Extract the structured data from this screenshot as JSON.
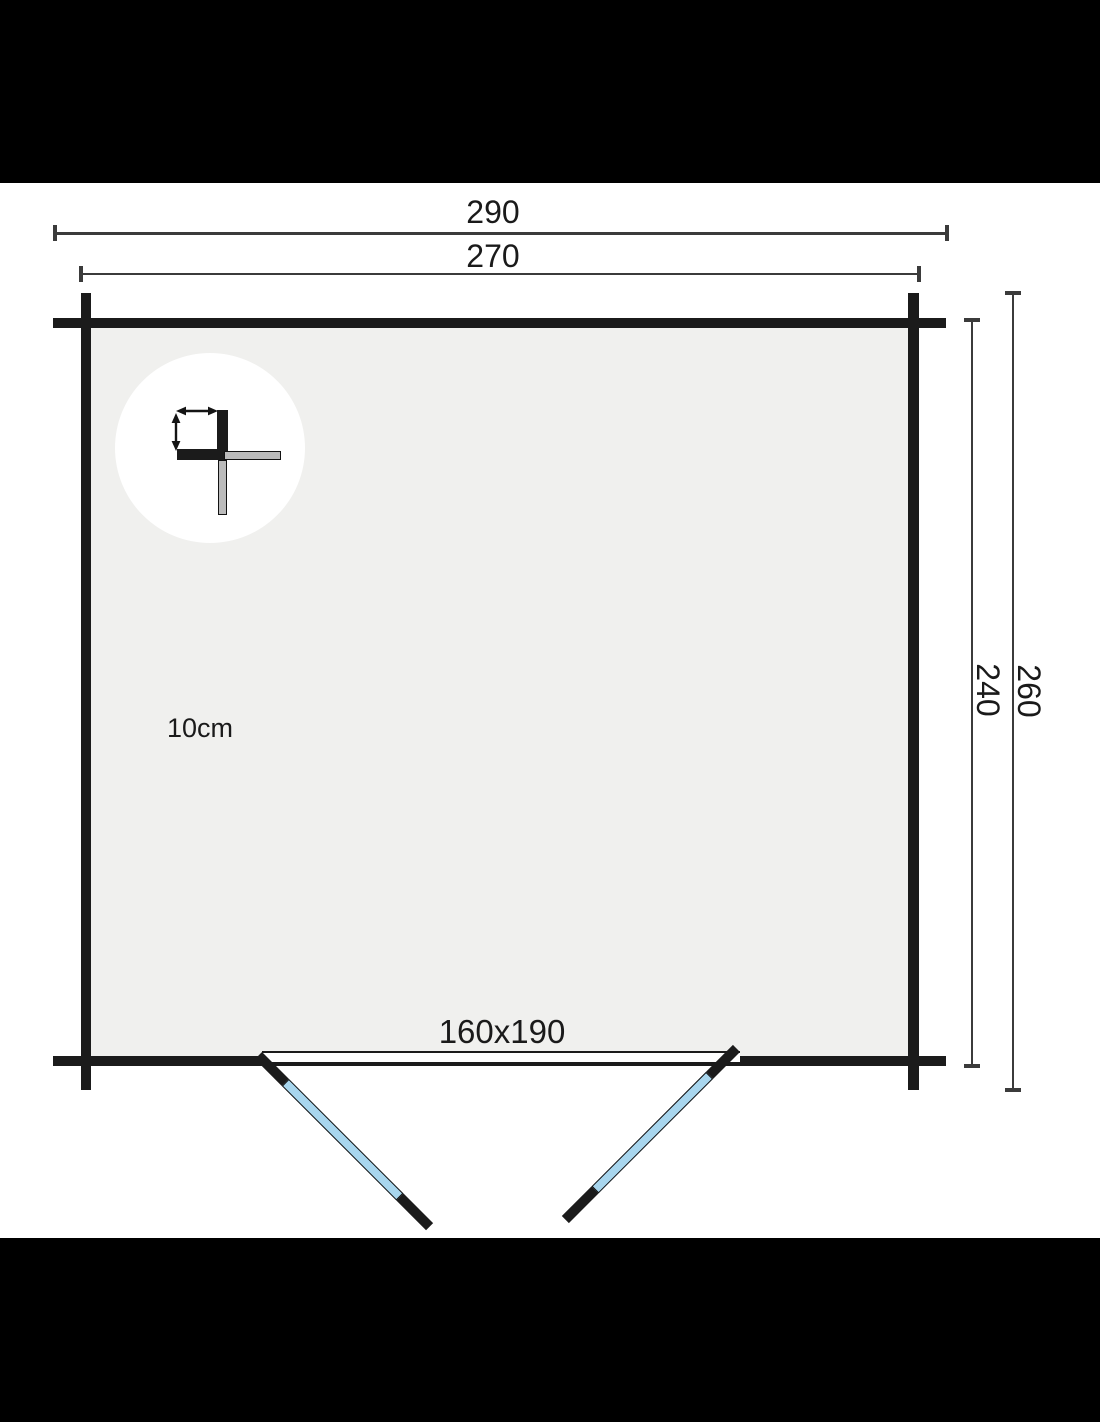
{
  "plan": {
    "dimensions": {
      "width_outer": "290",
      "width_inner": "270",
      "depth_inner": "240",
      "depth_outer": "260"
    },
    "wall_detail": {
      "thickness_label": "10cm"
    },
    "door": {
      "size_label": "160x190"
    },
    "colors": {
      "ink": "#1a1a1a",
      "wall": "#1b1b1b",
      "interior": "#f0f0ee",
      "door_panel": "#a8d6ee",
      "detail_gray": "#bbbbbb",
      "dim_line": "#3b3b3b",
      "letterbox": "#000000"
    }
  }
}
